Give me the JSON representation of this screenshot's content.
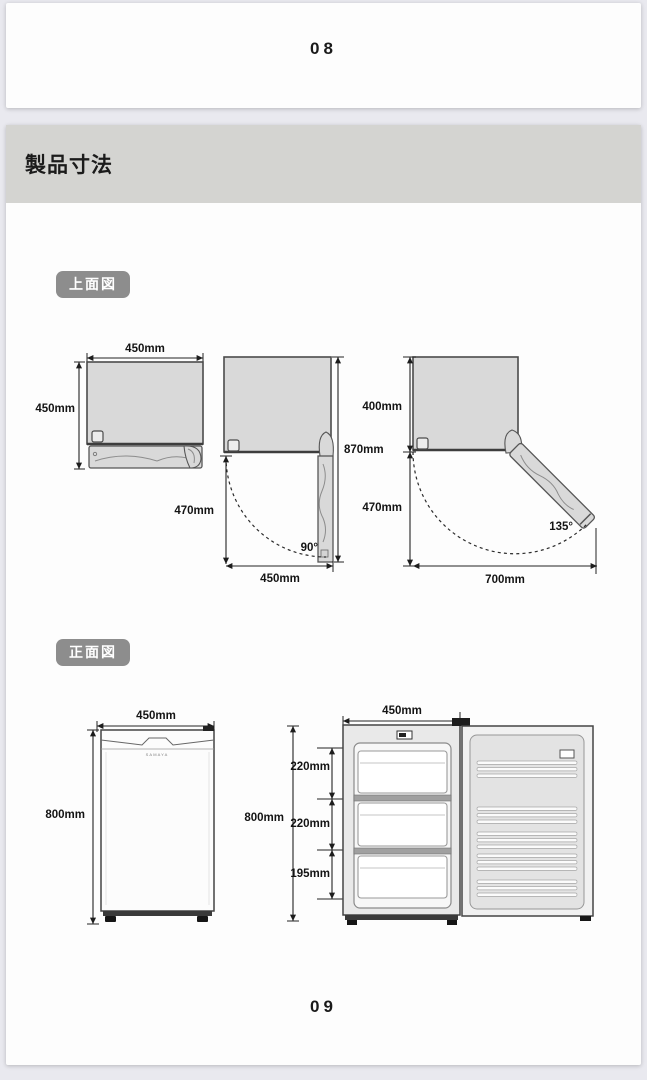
{
  "prev_page": {
    "number": "08"
  },
  "current_page": {
    "number": "09"
  },
  "header": {
    "title": "製品寸法"
  },
  "badges": {
    "top_view": "上面図",
    "front_view": "正面図"
  },
  "top_view": {
    "closed": {
      "top_width": "450mm",
      "side_depth": "450mm"
    },
    "open_90": {
      "total_depth": "870mm",
      "door_clearance": "470mm",
      "bottom_width": "450mm",
      "angle": "90°"
    },
    "open_135": {
      "body_depth": "400mm",
      "door_clearance": "470mm",
      "bottom_width": "700mm",
      "angle": "135°"
    }
  },
  "front_view": {
    "closed": {
      "top_width": "450mm",
      "height": "800mm",
      "brand": "SAMAYA"
    },
    "open": {
      "top_width": "450mm",
      "height": "800mm",
      "compartments": [
        "220mm",
        "220mm",
        "195mm"
      ]
    }
  },
  "colors": {
    "page_background": "#e9e9ef",
    "card_background": "#fdfdfd",
    "header_bar": "#d4d4d1",
    "badge_background": "#8d8d8d",
    "diagram_fill": "#d9d9d9",
    "line": "#232323"
  }
}
